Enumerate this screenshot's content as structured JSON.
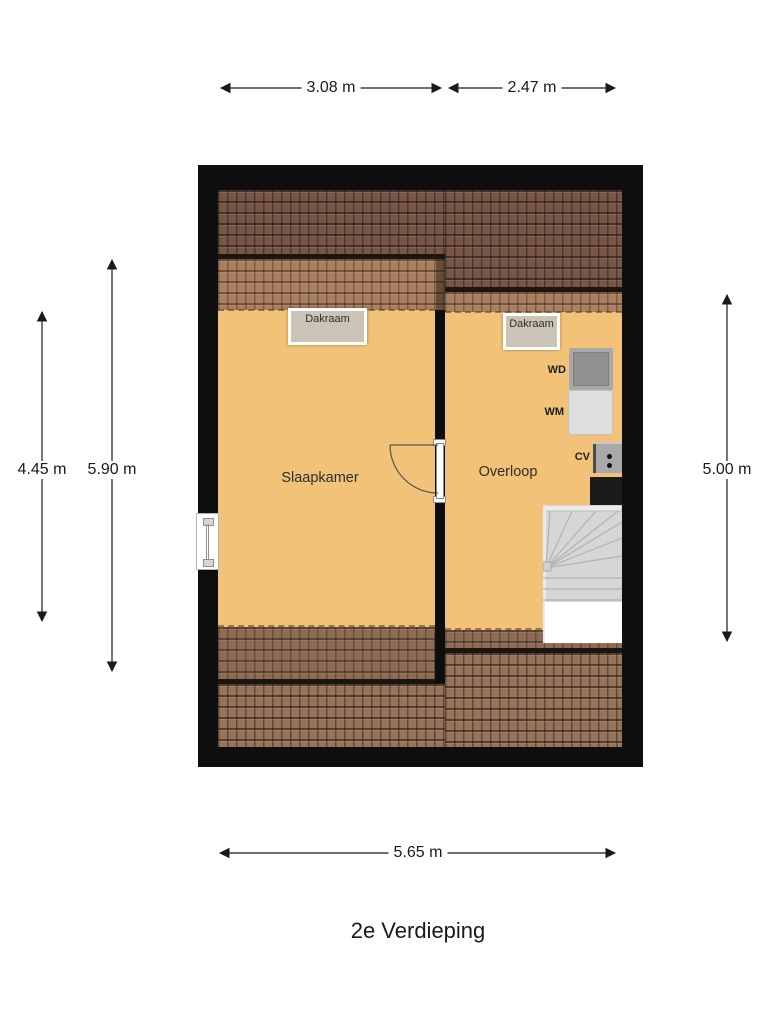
{
  "title": "2e Verdieping",
  "dimensions": {
    "top_left": "3.08 m",
    "top_right": "2.47 m",
    "left_room": "4.45 m",
    "left_total": "5.90 m",
    "right": "5.00 m",
    "bottom": "5.65 m"
  },
  "rooms": {
    "slaapkamer": "Slaapkamer",
    "overloop": "Overloop"
  },
  "labels": {
    "dakraam_left": "Dakraam",
    "dakraam_right": "Dakraam",
    "wd": "WD",
    "wm": "WM",
    "cv": "CV"
  },
  "colors": {
    "wall": "#0e0e0e",
    "floor": "#f2c278",
    "roof_dark": "#775648",
    "roof_light": "#aa8061",
    "roof_mid": "#8d6b55",
    "roof_mid2": "#977459",
    "dakraam": "#cac3b6"
  }
}
